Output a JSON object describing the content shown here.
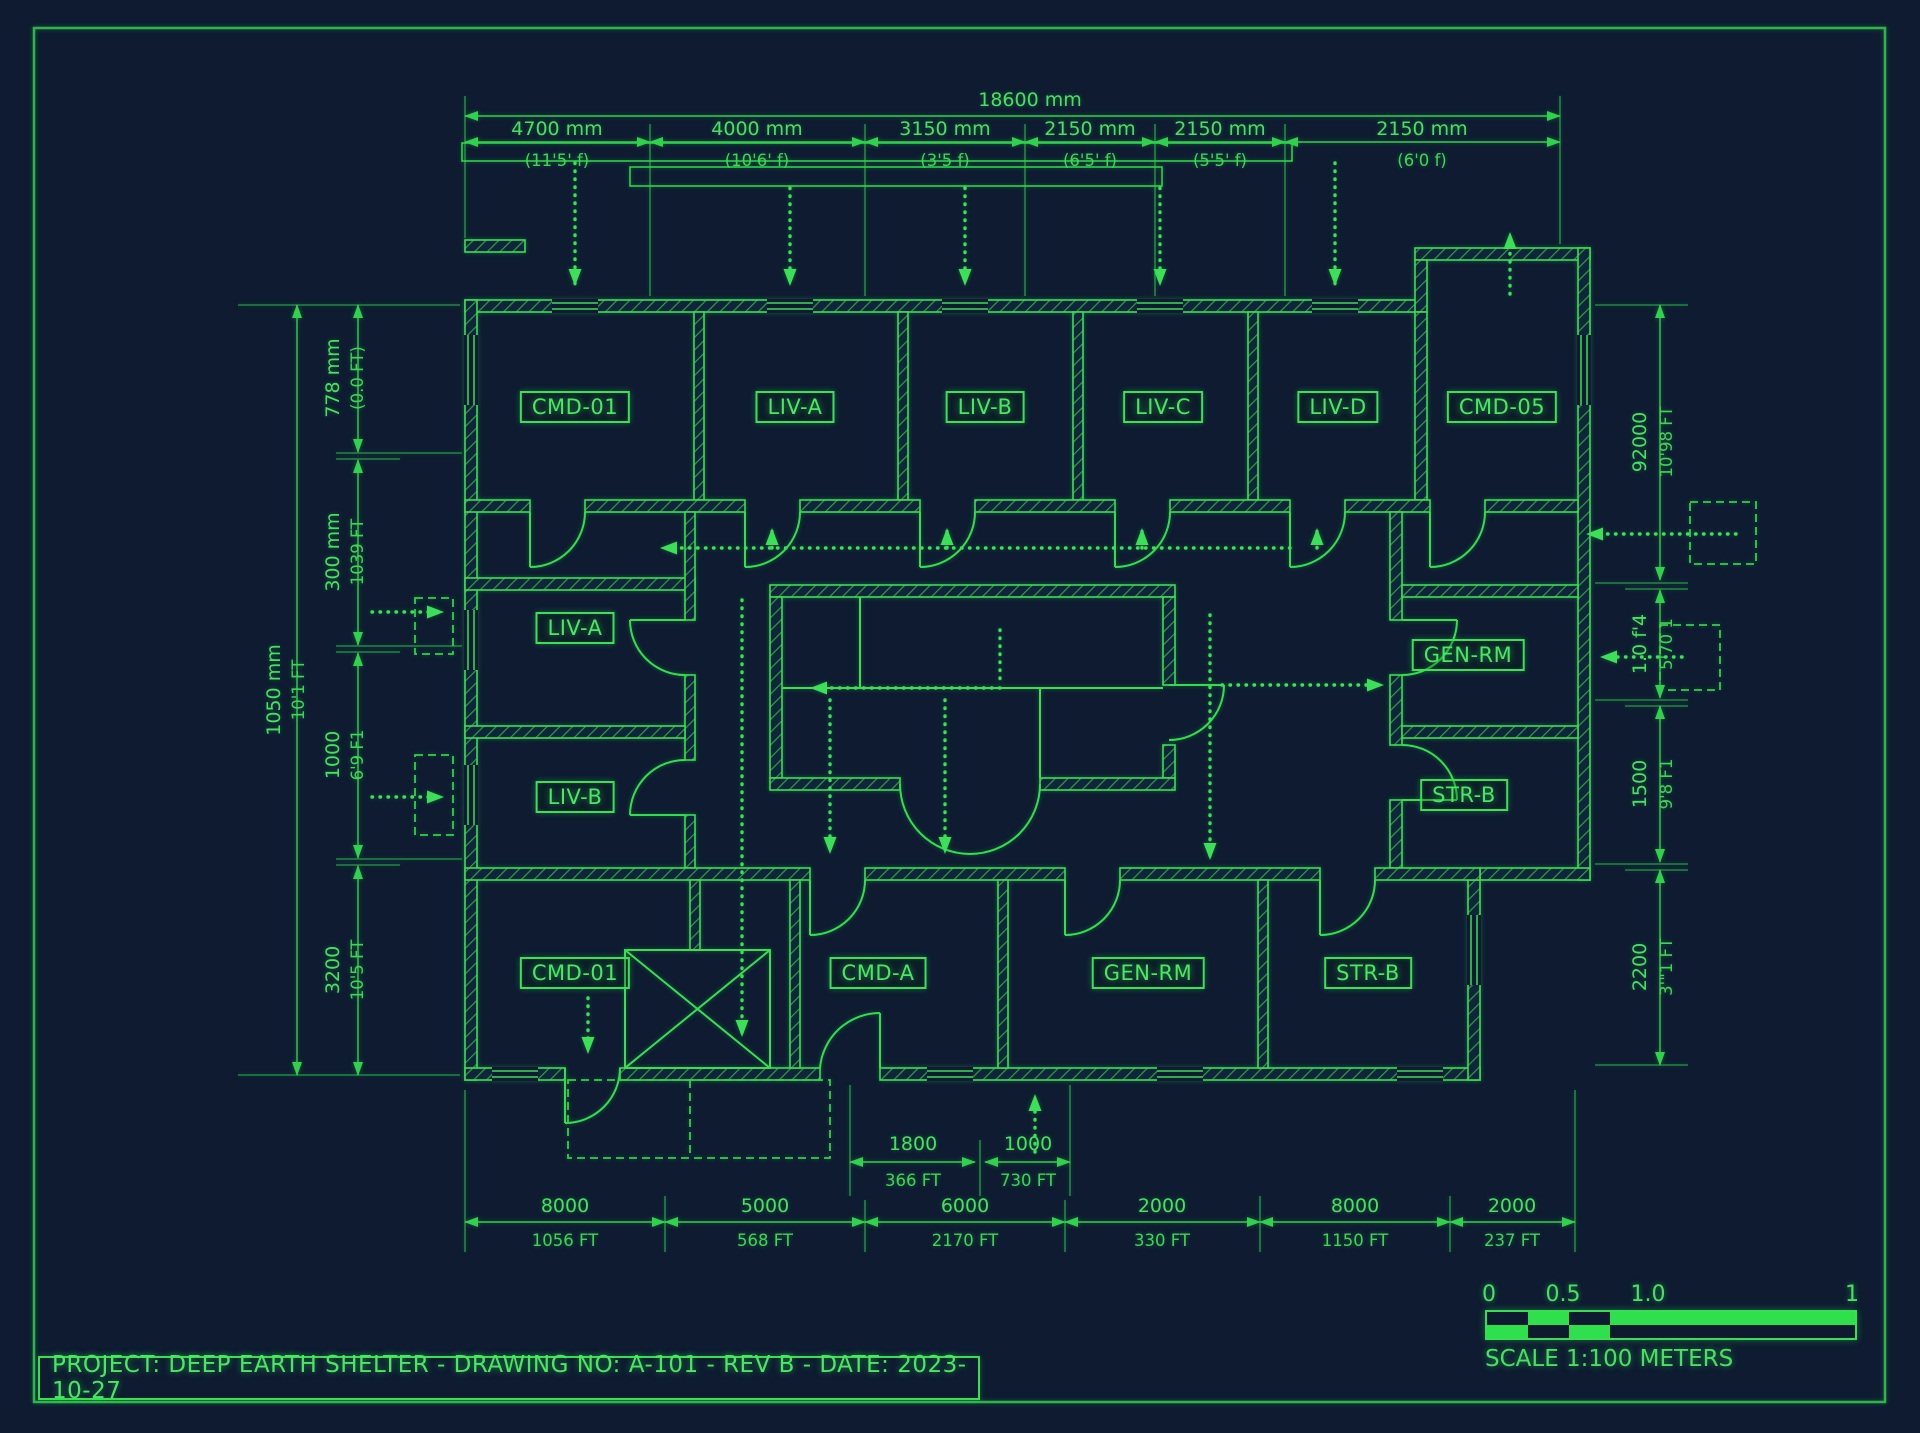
{
  "title_block": {
    "text": "PROJECT: DEEP EARTH SHELTER - DRAWING NO: A-101 - REV B - DATE: 2023-10-27"
  },
  "scale_bar": {
    "ticks": [
      "0",
      "0.5",
      "1.0",
      "1"
    ],
    "label": "SCALE 1:100 METERS"
  },
  "colors": {
    "background": "#0e1b31",
    "line_green": "#36e052",
    "dim_green": "#2fd24b",
    "text_green": "#46e25f"
  },
  "rooms": [
    {
      "id": "cmd-01-top",
      "label": "CMD-01"
    },
    {
      "id": "liv-a-top",
      "label": "LIV-A"
    },
    {
      "id": "liv-b-top",
      "label": "LIV-B"
    },
    {
      "id": "liv-c-top",
      "label": "LIV-C"
    },
    {
      "id": "liv-d-top",
      "label": "LIV-D"
    },
    {
      "id": "cmd-05",
      "label": "CMD-05"
    },
    {
      "id": "liv-a-mid",
      "label": "LIV-A"
    },
    {
      "id": "gen-rm-mid",
      "label": "GEN-RM"
    },
    {
      "id": "liv-b-mid",
      "label": "LIV-B"
    },
    {
      "id": "str-b-mid",
      "label": "STR-B"
    },
    {
      "id": "cmd-01-bottom",
      "label": "CMD-01"
    },
    {
      "id": "cmd-a",
      "label": "CMD-A"
    },
    {
      "id": "gen-rm-bottom",
      "label": "GEN-RM"
    },
    {
      "id": "str-b-bottom",
      "label": "STR-B"
    }
  ],
  "dimensions": {
    "top_overall": {
      "mm": "18600 mm"
    },
    "top_segments": [
      {
        "mm": "4700 mm",
        "ft": "(11'5' f)"
      },
      {
        "mm": "4000 mm",
        "ft": "(10'6' f)"
      },
      {
        "mm": "3150 mm",
        "ft": "(3'5 f)"
      },
      {
        "mm": "2150 mm",
        "ft": "(6'5' f)"
      },
      {
        "mm": "2150 mm",
        "ft": "(5'5' f)"
      },
      {
        "mm": "2150 mm",
        "ft": "(6'0 f)"
      }
    ],
    "left_overall": {
      "mm": "1050 mm",
      "ft": "10'1 FT"
    },
    "left_segments": [
      {
        "mm": "778 mm",
        "ft": "(0.0 FT)"
      },
      {
        "mm": "300 mm",
        "ft": "1039 FT"
      },
      {
        "mm": "1000",
        "ft": "6'9 F1"
      },
      {
        "mm": "3200",
        "ft": "10'5 FT"
      }
    ],
    "right_segments": [
      {
        "mm": "92000",
        "ft": "10'98 FT"
      },
      {
        "mm": "1.0 f'4",
        "ft": "5'70 1"
      },
      {
        "mm": "1500",
        "ft": "9'8 F1"
      },
      {
        "mm": "2200",
        "ft": "3'\"1 FT"
      }
    ],
    "bottom_inner": [
      {
        "mm": "1800",
        "ft": "366 FT"
      },
      {
        "mm": "1000",
        "ft": "730 FT"
      }
    ],
    "bottom_segments": [
      {
        "mm": "8000",
        "ft": "1056 FT"
      },
      {
        "mm": "5000",
        "ft": "568 FT"
      },
      {
        "mm": "6000",
        "ft": "2170 FT"
      },
      {
        "mm": "2000",
        "ft": "330 FT"
      },
      {
        "mm": "8000",
        "ft": "1150 FT"
      },
      {
        "mm": "2000",
        "ft": "237 FT"
      }
    ]
  }
}
